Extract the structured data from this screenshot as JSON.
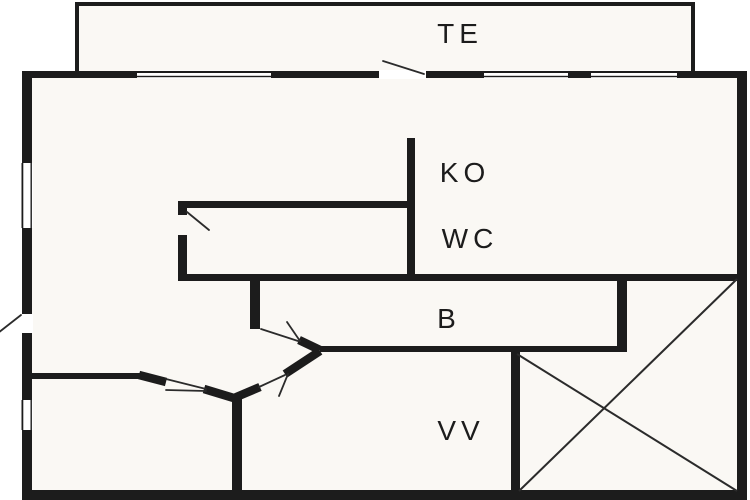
{
  "plan": {
    "rooms": [
      {
        "id": "te",
        "label": "TE"
      },
      {
        "id": "ko",
        "label": "KO"
      },
      {
        "id": "wc",
        "label": "WC"
      },
      {
        "id": "b",
        "label": "B"
      },
      {
        "id": "vv",
        "label": "VV"
      }
    ],
    "colors": {
      "wall": "#1c1c1c",
      "floor": "#faf8f4",
      "background": "#ffffff",
      "thin_line": "#2b2b2b"
    }
  }
}
